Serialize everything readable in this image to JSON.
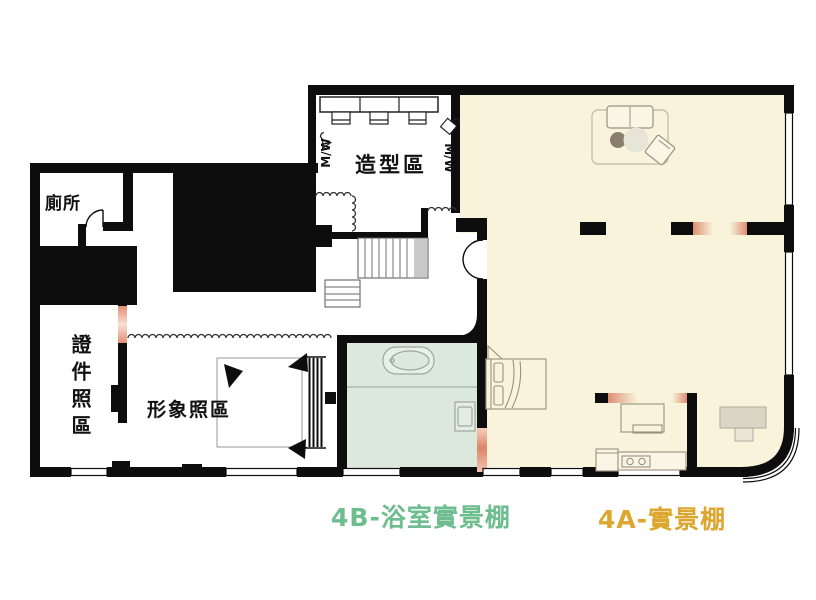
{
  "plan": {
    "rooms": {
      "toilet": "廁所",
      "styling": "造型區",
      "id_photo": "證件照區",
      "portrait": "形象照區"
    },
    "zones": {
      "bath_studio": {
        "label": "4B-浴室實景棚",
        "color": "#6dbd8f"
      },
      "main_studio": {
        "label": "4A-實景棚",
        "color": "#dca62f"
      }
    },
    "racks": {
      "left": "M/W",
      "right": "M/W"
    },
    "colors": {
      "main_studio_floor": "#f8f3da",
      "bath_floor": "#dde8dc",
      "accent_pink": "#e38f73",
      "wall": "#0d0d0d"
    }
  }
}
